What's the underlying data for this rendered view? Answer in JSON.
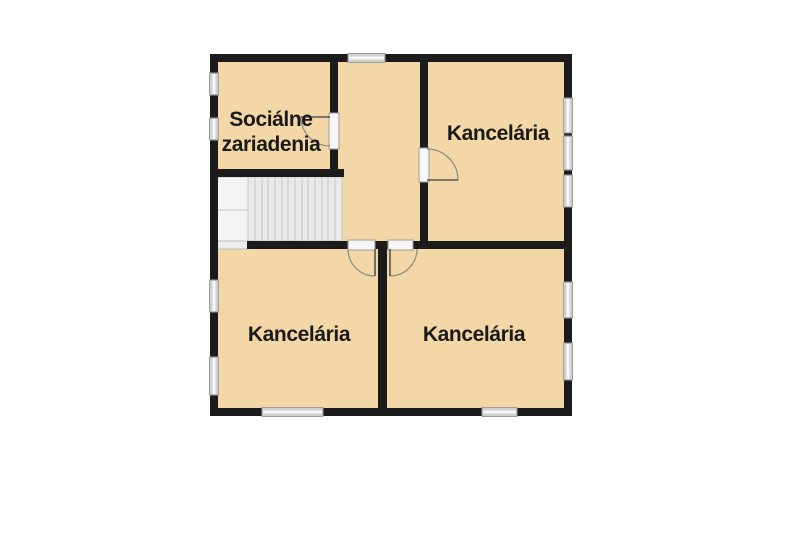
{
  "diagram_type": "floor-plan",
  "rooms": [
    {
      "id": "socialne-zariadenia",
      "label": "Sociálne zariadenia",
      "label_lines": [
        "Sociálne",
        "zariadenia"
      ]
    },
    {
      "id": "kancelaria-top-right",
      "label": "Kancelária"
    },
    {
      "id": "kancelaria-bottom-left",
      "label": "Kancelária"
    },
    {
      "id": "kancelaria-bottom-right",
      "label": "Kancelária"
    }
  ],
  "features": [
    "staircase",
    "doors",
    "windows"
  ],
  "colors": {
    "room_fill": "#f3d7a6",
    "wall": "#1b1b1b",
    "window_fill": "#f7f7f7",
    "window_frame": "#9e9e9e",
    "window_base": "#cfcfcf",
    "stair_fill": "#eaeaea",
    "stair_landing": "#f4f4f4",
    "stair_line": "#c6c6c6",
    "door_arc": "#8a8a8a",
    "door_leaf": "#555555",
    "background": "#ffffff",
    "label_text": "#1a1a1a"
  }
}
